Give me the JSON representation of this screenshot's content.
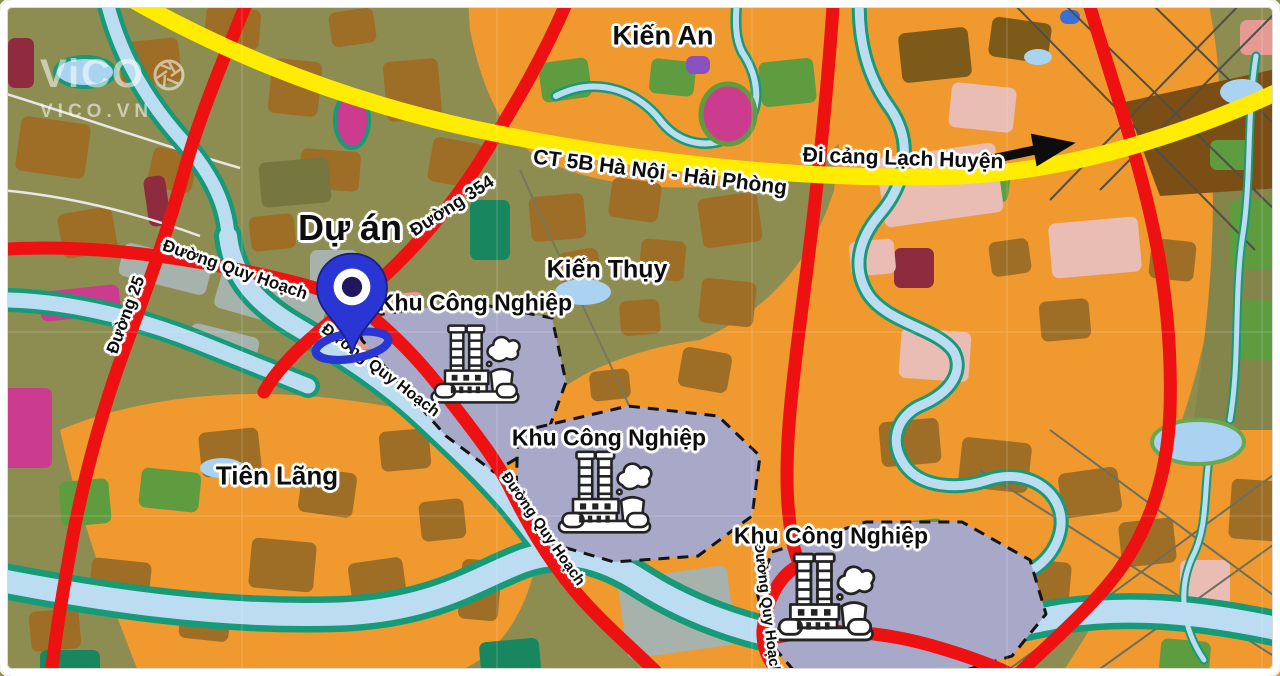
{
  "watermark": {
    "brand": "ViCO",
    "site": "VICO.VN",
    "icon": "camera-aperture-icon"
  },
  "labels": {
    "kien_an": "Kiến An",
    "kien_thuy": "Kiến Thụy",
    "tien_lang": "Tiên Lãng",
    "project": "Dự án",
    "highway": "CT 5B Hà Nội - Hải Phòng",
    "port_direction": "Đi cảng Lạch Huyện",
    "road_354": "Đường 354",
    "road_25": "Đường 25",
    "planned_road": "Đường Quy Hoạch",
    "industrial_zone": "Khu Công Nghiệp"
  },
  "markers": {
    "project_pin": "blue-map-pin",
    "industrial_icon": "factory-icon",
    "direction_arrow": "arrow-right-icon"
  },
  "colors": {
    "highway_yellow": "#ffec00",
    "main_road_red": "#ee1111",
    "river_blue": "#bcdcf2",
    "river_bank_teal": "#169a78",
    "farmland_orange": "#f0992e",
    "rural_olive": "#8d8d51",
    "industrial_zone_fill": "#a8a8c8",
    "marker_blue": "#2a36d4"
  }
}
